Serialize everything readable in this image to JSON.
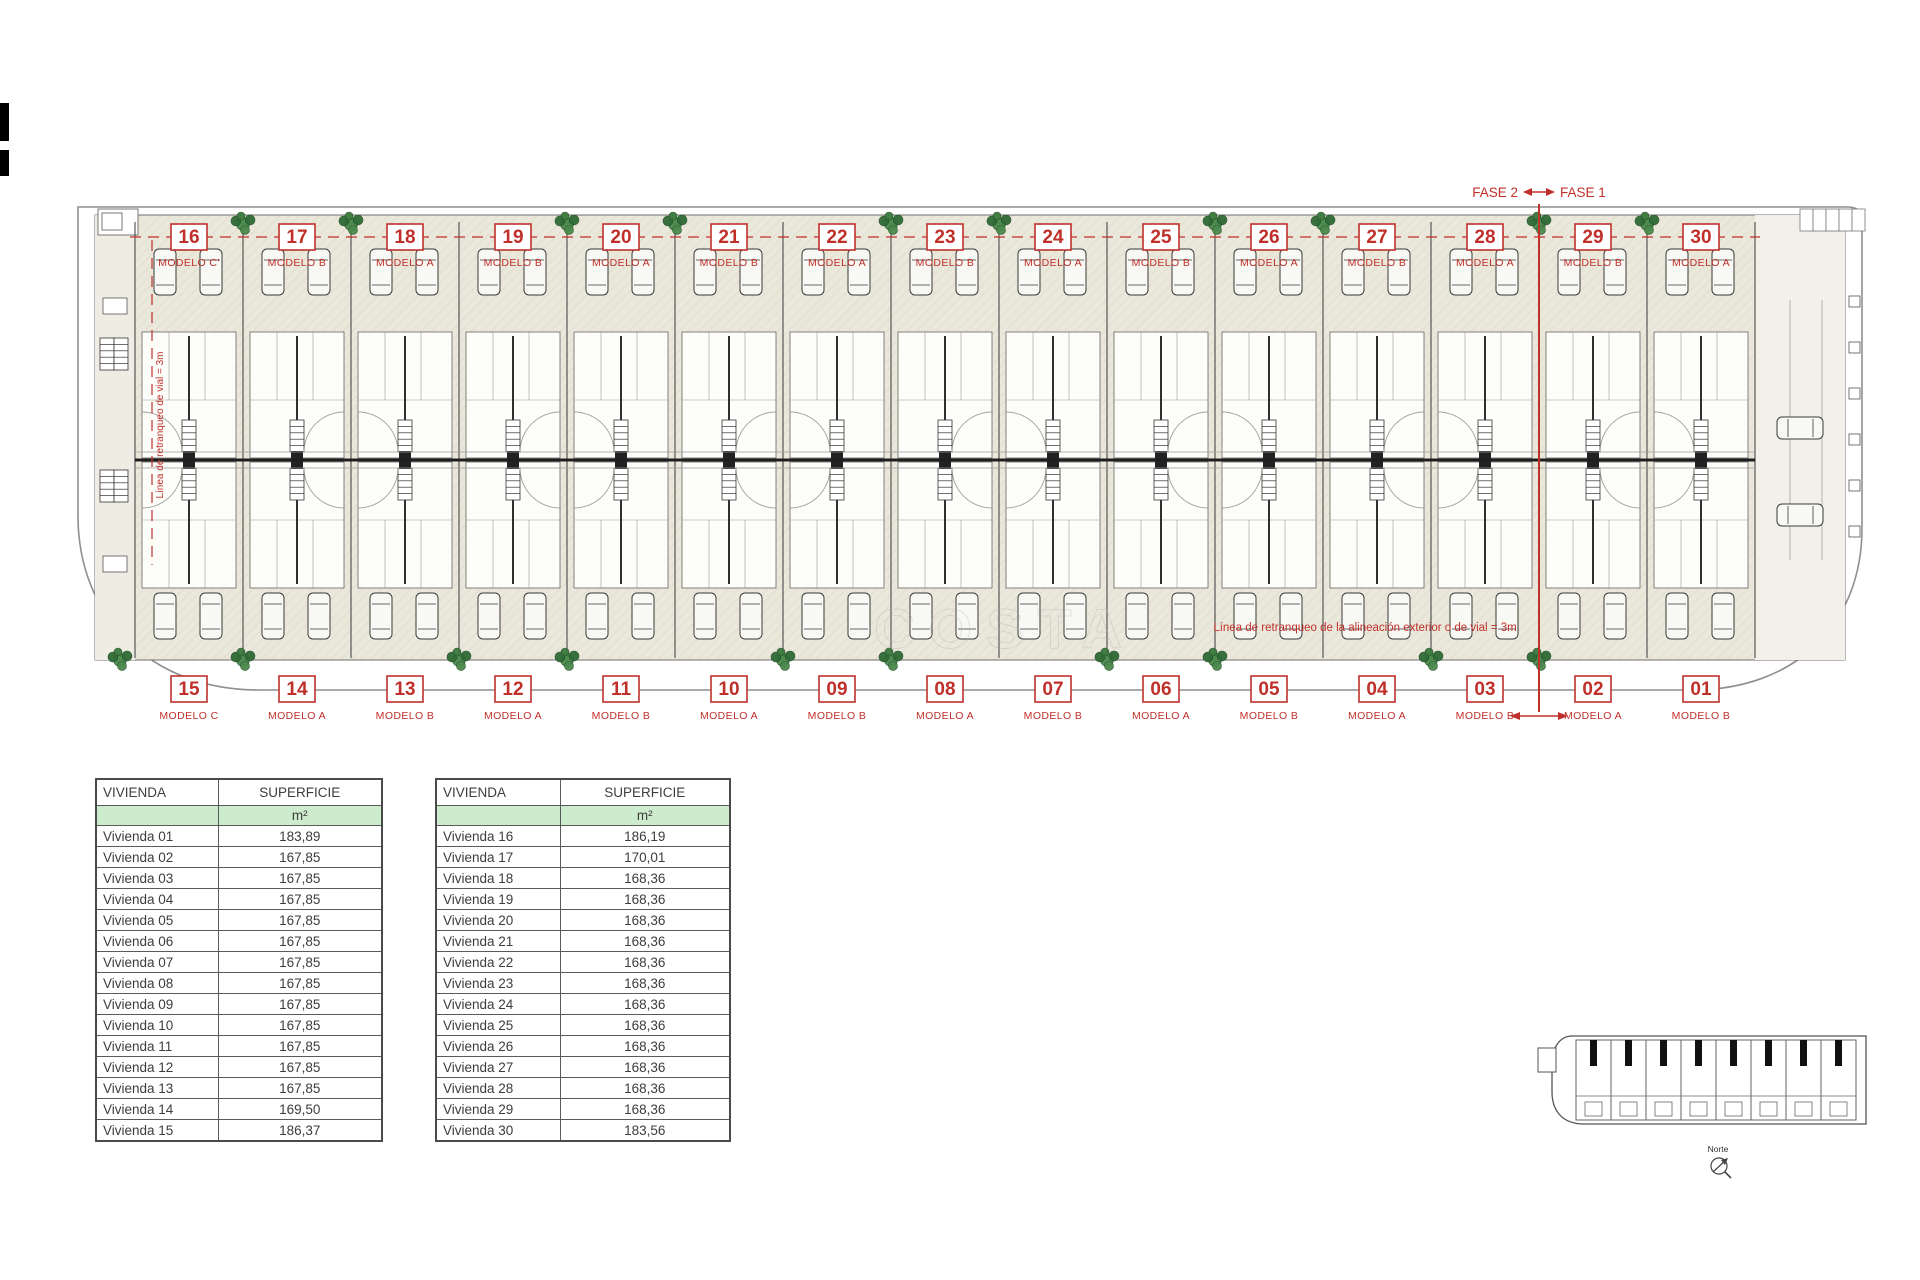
{
  "fase": {
    "fase2": "FASE 2",
    "fase1": "FASE 1"
  },
  "plan": {
    "top_units": [
      {
        "number": "16",
        "modelo": "MODELO C'"
      },
      {
        "number": "17",
        "modelo": "MODELO B"
      },
      {
        "number": "18",
        "modelo": "MODELO A"
      },
      {
        "number": "19",
        "modelo": "MODELO B"
      },
      {
        "number": "20",
        "modelo": "MODELO A"
      },
      {
        "number": "21",
        "modelo": "MODELO B"
      },
      {
        "number": "22",
        "modelo": "MODELO A"
      },
      {
        "number": "23",
        "modelo": "MODELO B"
      },
      {
        "number": "24",
        "modelo": "MODELO A"
      },
      {
        "number": "25",
        "modelo": "MODELO B"
      },
      {
        "number": "26",
        "modelo": "MODELO A"
      },
      {
        "number": "27",
        "modelo": "MODELO B"
      },
      {
        "number": "28",
        "modelo": "MODELO A"
      },
      {
        "number": "29",
        "modelo": "MODELO B"
      },
      {
        "number": "30",
        "modelo": "MODELO A"
      }
    ],
    "bottom_units": [
      {
        "number": "15",
        "modelo": "MODELO C"
      },
      {
        "number": "14",
        "modelo": "MODELO A"
      },
      {
        "number": "13",
        "modelo": "MODELO B"
      },
      {
        "number": "12",
        "modelo": "MODELO A"
      },
      {
        "number": "11",
        "modelo": "MODELO B"
      },
      {
        "number": "10",
        "modelo": "MODELO A"
      },
      {
        "number": "09",
        "modelo": "MODELO B"
      },
      {
        "number": "08",
        "modelo": "MODELO A"
      },
      {
        "number": "07",
        "modelo": "MODELO B"
      },
      {
        "number": "06",
        "modelo": "MODELO A"
      },
      {
        "number": "05",
        "modelo": "MODELO B"
      },
      {
        "number": "04",
        "modelo": "MODELO A"
      },
      {
        "number": "03",
        "modelo": "MODELO B"
      },
      {
        "number": "02",
        "modelo": "MODELO A"
      },
      {
        "number": "01",
        "modelo": "MODELO B"
      }
    ],
    "annotations": {
      "setback_main": "Línea de retranqueo de la alineación exterior o de vial = 3m",
      "setback_left": "Línea de retranqueo de vial = 3m"
    },
    "watermark": "COSTA",
    "module_count": 15
  },
  "tables": [
    {
      "title_col": "VIVIENDA",
      "value_col": "SUPERFICIE",
      "unit": "m²",
      "rows": [
        {
          "name": "Vivienda 01",
          "value": "183,89"
        },
        {
          "name": "Vivienda 02",
          "value": "167,85"
        },
        {
          "name": "Vivienda 03",
          "value": "167,85"
        },
        {
          "name": "Vivienda 04",
          "value": "167,85"
        },
        {
          "name": "Vivienda 05",
          "value": "167,85"
        },
        {
          "name": "Vivienda 06",
          "value": "167,85"
        },
        {
          "name": "Vivienda 07",
          "value": "167,85"
        },
        {
          "name": "Vivienda 08",
          "value": "167,85"
        },
        {
          "name": "Vivienda 09",
          "value": "167,85"
        },
        {
          "name": "Vivienda 10",
          "value": "167,85"
        },
        {
          "name": "Vivienda 11",
          "value": "167,85"
        },
        {
          "name": "Vivienda 12",
          "value": "167,85"
        },
        {
          "name": "Vivienda 13",
          "value": "167,85"
        },
        {
          "name": "Vivienda 14",
          "value": "169,50"
        },
        {
          "name": "Vivienda 15",
          "value": "186,37"
        }
      ]
    },
    {
      "title_col": "VIVIENDA",
      "value_col": "SUPERFICIE",
      "unit": "m²",
      "rows": [
        {
          "name": "Vivienda 16",
          "value": "186,19"
        },
        {
          "name": "Vivienda 17",
          "value": "170,01"
        },
        {
          "name": "Vivienda 18",
          "value": "168,36"
        },
        {
          "name": "Vivienda 19",
          "value": "168,36"
        },
        {
          "name": "Vivienda 20",
          "value": "168,36"
        },
        {
          "name": "Vivienda 21",
          "value": "168,36"
        },
        {
          "name": "Vivienda 22",
          "value": "168,36"
        },
        {
          "name": "Vivienda 23",
          "value": "168,36"
        },
        {
          "name": "Vivienda 24",
          "value": "168,36"
        },
        {
          "name": "Vivienda 25",
          "value": "168,36"
        },
        {
          "name": "Vivienda 26",
          "value": "168,36"
        },
        {
          "name": "Vivienda 27",
          "value": "168,36"
        },
        {
          "name": "Vivienda 28",
          "value": "168,36"
        },
        {
          "name": "Vivienda 29",
          "value": "168,36"
        },
        {
          "name": "Vivienda 30",
          "value": "183,56"
        }
      ]
    }
  ],
  "minimap": {
    "norte": "Norte",
    "unit_count": 8
  },
  "colors": {
    "accent_red": "#c0302b",
    "plant_green": "#4a8a4c",
    "table_header_green": "#cdeccd",
    "beige": "#eae7db"
  }
}
